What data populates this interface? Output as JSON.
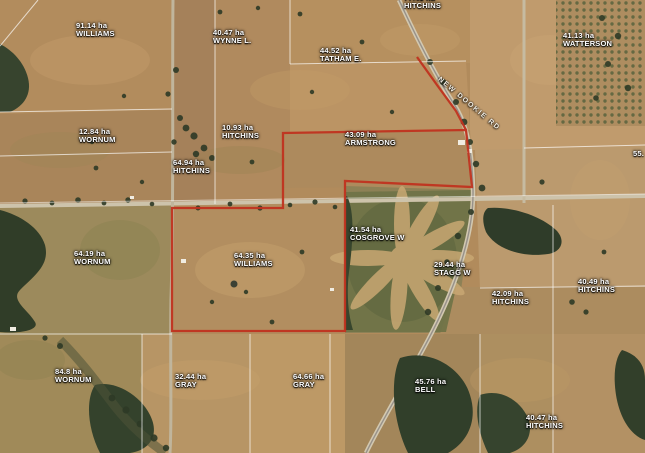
{
  "map": {
    "kind": "aerial-cadastral-parcel-map",
    "highlight_color": "#c0331f",
    "boundary_line_color": "#ffffff",
    "highlighted_parcel": "64.35 ha WILLIAMS",
    "road_label": {
      "text": "NEW DOOKIE RD",
      "x": 441,
      "y": 76,
      "rotate": 40
    },
    "parcels": [
      {
        "area": "91.14 ha",
        "owner": "WILLIAMS",
        "x": 76,
        "y": 22
      },
      {
        "area": "40.47 ha",
        "owner": "WYNNE L.",
        "x": 213,
        "y": 29
      },
      {
        "area": "44.52 ha",
        "owner": "TATHAM E.",
        "x": 320,
        "y": 47
      },
      {
        "area": "77.41 ha",
        "owner": "HITCHINS",
        "x": 404,
        "y": -6
      },
      {
        "area": "41.13 ha",
        "owner": "WATTERSON",
        "x": 563,
        "y": 32
      },
      {
        "area": "12.84 ha",
        "owner": "WORNUM",
        "x": 79,
        "y": 128
      },
      {
        "area": "10.93 ha",
        "owner": "HITCHINS",
        "x": 222,
        "y": 124
      },
      {
        "area": "64.94 ha",
        "owner": "HITCHINS",
        "x": 173,
        "y": 159
      },
      {
        "area": "43.09 ha",
        "owner": "ARMSTRONG",
        "x": 345,
        "y": 131
      },
      {
        "area": "41.54 ha",
        "owner": "COSGROVE W",
        "x": 350,
        "y": 226
      },
      {
        "area": "29.44 ha",
        "owner": "STAGG W",
        "x": 434,
        "y": 261
      },
      {
        "area": "64.35 ha",
        "owner": "WILLIAMS",
        "x": 234,
        "y": 252,
        "highlighted": true
      },
      {
        "area": "64.19 ha",
        "owner": "WORNUM",
        "x": 74,
        "y": 250
      },
      {
        "area": "42.09 ha",
        "owner": "HITCHINS",
        "x": 492,
        "y": 290
      },
      {
        "area": "40.49 ha",
        "owner": "HITCHINS",
        "x": 578,
        "y": 278
      },
      {
        "area": "84.8 ha",
        "owner": "WORNUM",
        "x": 55,
        "y": 368
      },
      {
        "area": "32.44 ha",
        "owner": "GRAY",
        "x": 175,
        "y": 373
      },
      {
        "area": "64.66 ha",
        "owner": "GRAY",
        "x": 293,
        "y": 373
      },
      {
        "area": "45.76 ha",
        "owner": "BELL",
        "x": 415,
        "y": 378
      },
      {
        "area": "40.47 ha",
        "owner": "HITCHINS",
        "x": 526,
        "y": 414
      }
    ],
    "partial_labels": [
      {
        "text": "55.",
        "x": 633,
        "y": 150
      }
    ]
  }
}
